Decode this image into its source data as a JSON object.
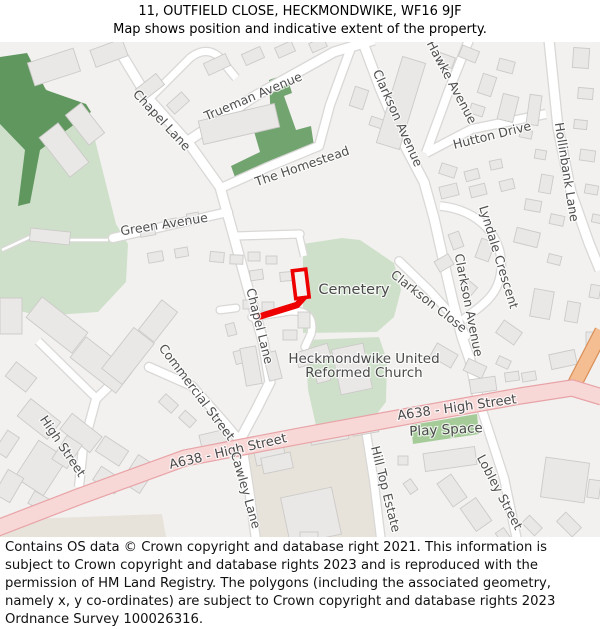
{
  "header": {
    "title": "11, OUTFIELD CLOSE, HECKMONDWIKE, WF16 9JF",
    "subtitle": "Map shows position and indicative extent of the property."
  },
  "footer": {
    "text": "Contains OS data © Crown copyright and database right 2021. This information is subject to Crown copyright and database rights 2023 and is reproduced with the permission of HM Land Registry. The polygons (including the associated geometry, namely x, y co-ordinates) are subject to Crown copyright and database rights 2023 Ordnance Survey 100026316."
  },
  "property": {
    "name": "11 Outfield Close - indicative extent",
    "outline_color": "#ee0000"
  },
  "colors": {
    "background": "#f2f1ef",
    "road_fill": "#ffffff",
    "road_casing": "#d9d8d6",
    "a_road_fill": "#f8d7d7",
    "a_road_casing": "#e8a3a6",
    "orange_road_fill": "#f4bd92",
    "orange_road_casing": "#d98e55",
    "building_fill": "#e9e8e6",
    "building_stroke": "#cbcac8",
    "woodland_green": "#60975f",
    "homestead_green": "#72a470",
    "field_green": "#cfe0ca",
    "play_space_green": "#a5cb99",
    "retail_beige": "#e8e3da",
    "label_gray": "#4f4f4f"
  },
  "map": {
    "labels": [
      {
        "text": "Chapel Lane",
        "x": 162,
        "y": 120,
        "rot": 47,
        "size": 12.5
      },
      {
        "text": "Trueman Avenue",
        "x": 253,
        "y": 96,
        "rot": -23,
        "size": 12.5
      },
      {
        "text": "Clarkson Avenue",
        "x": 398,
        "y": 118,
        "rot": 66,
        "size": 12.5
      },
      {
        "text": "Hawke Avenue",
        "x": 452,
        "y": 82,
        "rot": 62,
        "size": 12.5
      },
      {
        "text": "Hutton Drive",
        "x": 492,
        "y": 135,
        "rot": -14,
        "size": 12.5
      },
      {
        "text": "Hollinbank Lane",
        "x": 567,
        "y": 172,
        "rot": 81,
        "size": 12.5
      },
      {
        "text": "The Homestead",
        "x": 302,
        "y": 166,
        "rot": -19,
        "size": 12.5
      },
      {
        "text": "Green Avenue",
        "x": 164,
        "y": 224,
        "rot": -9,
        "size": 12.5
      },
      {
        "text": "Chapel Lane",
        "x": 260,
        "y": 326,
        "rot": 76,
        "size": 12.5
      },
      {
        "text": "Cemetery",
        "x": 354,
        "y": 290,
        "rot": 0,
        "size": 14.5,
        "color": "#4a4a4a"
      },
      {
        "text": "Lyndale Crescent",
        "x": 499,
        "y": 257,
        "rot": 73,
        "size": 12.5
      },
      {
        "text": "Clarkson Close",
        "x": 429,
        "y": 301,
        "rot": 38,
        "size": 12.5
      },
      {
        "text": "Clarkson Avenue",
        "x": 469,
        "y": 305,
        "rot": 79,
        "size": 12.5
      },
      {
        "text": "Heckmondwike United",
        "x": 364,
        "y": 359,
        "rot": 0,
        "size": 13.5,
        "color": "#4a4a4a"
      },
      {
        "text": "Reformed Church",
        "x": 364,
        "y": 373,
        "rot": 0,
        "size": 13.5,
        "color": "#4a4a4a"
      },
      {
        "text": "Commercial Street",
        "x": 197,
        "y": 392,
        "rot": 53,
        "size": 12.5
      },
      {
        "text": "High Street",
        "x": 63,
        "y": 446,
        "rot": 56,
        "size": 12.5
      },
      {
        "text": "A638 - High Street",
        "x": 228,
        "y": 452,
        "rot": -13,
        "size": 13,
        "color": "#4a4a4a"
      },
      {
        "text": "A638 - High Street",
        "x": 457,
        "y": 408,
        "rot": -8,
        "size": 13,
        "color": "#4a4a4a"
      },
      {
        "text": "Play Space",
        "x": 446,
        "y": 430,
        "rot": -3,
        "size": 13.5,
        "color": "#4a4a4a"
      },
      {
        "text": "Cawley Lane",
        "x": 246,
        "y": 490,
        "rot": 74,
        "size": 12.5
      },
      {
        "text": "Hill Top Estate",
        "x": 386,
        "y": 489,
        "rot": 76,
        "size": 12.5
      },
      {
        "text": "Lobley Street",
        "x": 500,
        "y": 492,
        "rot": 62,
        "size": 12.5
      }
    ]
  }
}
